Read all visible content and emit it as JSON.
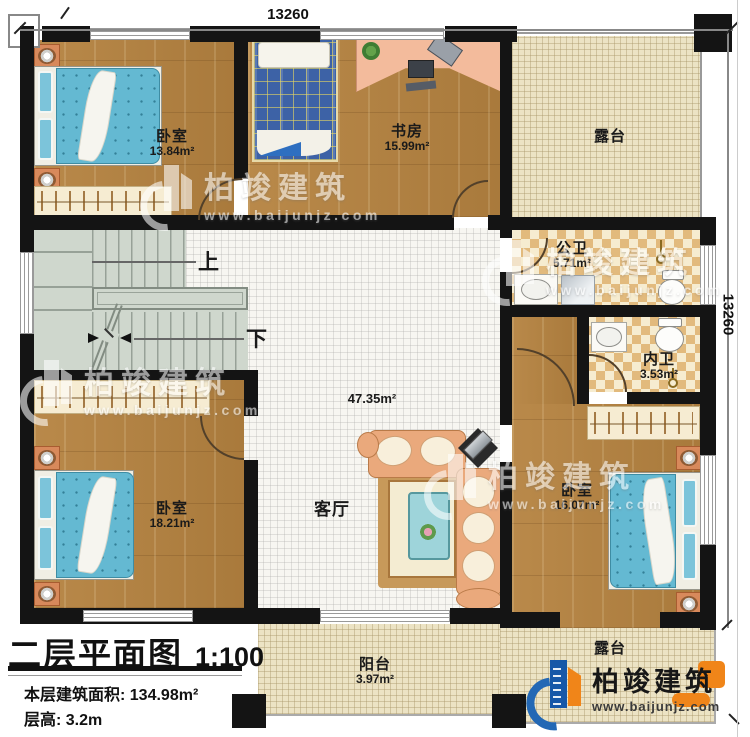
{
  "dimensions": {
    "top": "13260",
    "right": "13260"
  },
  "rooms": {
    "bedroom_a": {
      "name": "卧室",
      "area": "13.84m²"
    },
    "study": {
      "name": "书房",
      "area": "15.99m²"
    },
    "terrace_top": {
      "name": "露台",
      "area": ""
    },
    "public_bath": {
      "name": "公卫",
      "area": "5.71m²"
    },
    "ensuite_bath": {
      "name": "内卫",
      "area": "3.53m²"
    },
    "living": {
      "name": "客厅",
      "area": "47.35m²"
    },
    "bedroom_b": {
      "name": "卧室",
      "area": "18.21m²"
    },
    "bedroom_c": {
      "name": "卧室",
      "area": "16.07m²"
    },
    "balcony": {
      "name": "阳台",
      "area": "3.97m²"
    },
    "terrace_bottom": {
      "name": "露台",
      "area": ""
    }
  },
  "stairs": {
    "up_label": "上",
    "down_label": "下"
  },
  "title_block": {
    "plan_title": "二层平面图",
    "scale": "1:100",
    "floor_area": "本层建筑面积: 134.98m²",
    "floor_height": "层高: 3.2m"
  },
  "branding": {
    "company": "柏竣建筑",
    "website": "www.baijunjz.com"
  },
  "watermark": {
    "company": "柏竣建筑",
    "website": "www.baijunjz.com"
  },
  "colors": {
    "wall": "#141414",
    "wood_floor": "#b2813f",
    "white_tile": "#f7f6f1",
    "terrace_tile": "#ece3c4",
    "bath_checker": "#e2ba7d",
    "stair": "#cfd7cd",
    "bed": "#64b9d2",
    "sofa": "#eaa97c",
    "brand_blue": "#1758a8",
    "brand_orange": "#f08519"
  }
}
